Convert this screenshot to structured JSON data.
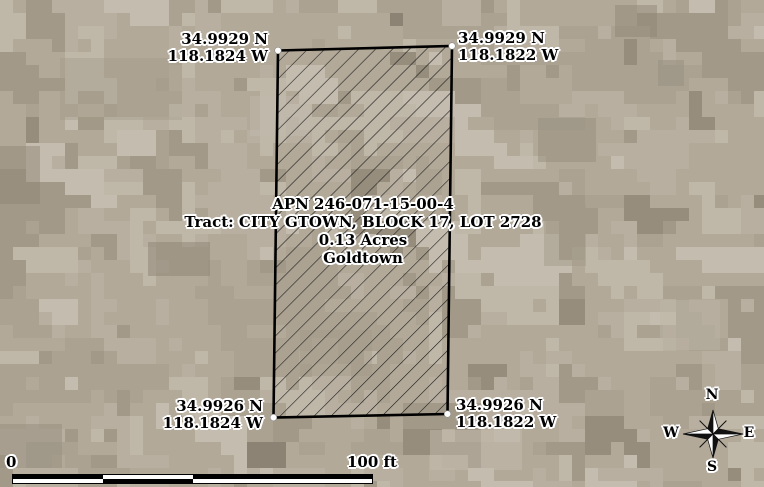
{
  "map": {
    "parcel": {
      "apn": "APN 246-071-15-00-4",
      "tract": "Tract: CITY GTOWN, BLOCK 17, LOT 2728",
      "acreage": "0.13 Acres",
      "city": "Goldtown",
      "corners": {
        "top_left": {
          "lat": "34.9929 N",
          "lon": "118.1824 W"
        },
        "top_right": {
          "lat": "34.9929 N",
          "lon": "118.1822 W"
        },
        "bottom_left": {
          "lat": "34.9926 N",
          "lon": "118.1824 W"
        },
        "bottom_right": {
          "lat": "34.9926 N",
          "lon": "118.1822 W"
        }
      }
    },
    "scale_bar": {
      "start_label": "0",
      "end_label": "100 ft"
    },
    "compass": {
      "north": "N",
      "east": "E",
      "south": "S",
      "west": "W"
    },
    "colors": {
      "boundary": "#000000",
      "hatch": "#1c1c1c",
      "label_text": "#000000",
      "label_halo": "#ffffff",
      "imagery_palette": [
        "#b2a999",
        "#b8afa0",
        "#aba292",
        "#bfb7a8",
        "#a29988",
        "#c4bcae",
        "#968d7d",
        "#8d8374"
      ]
    }
  }
}
